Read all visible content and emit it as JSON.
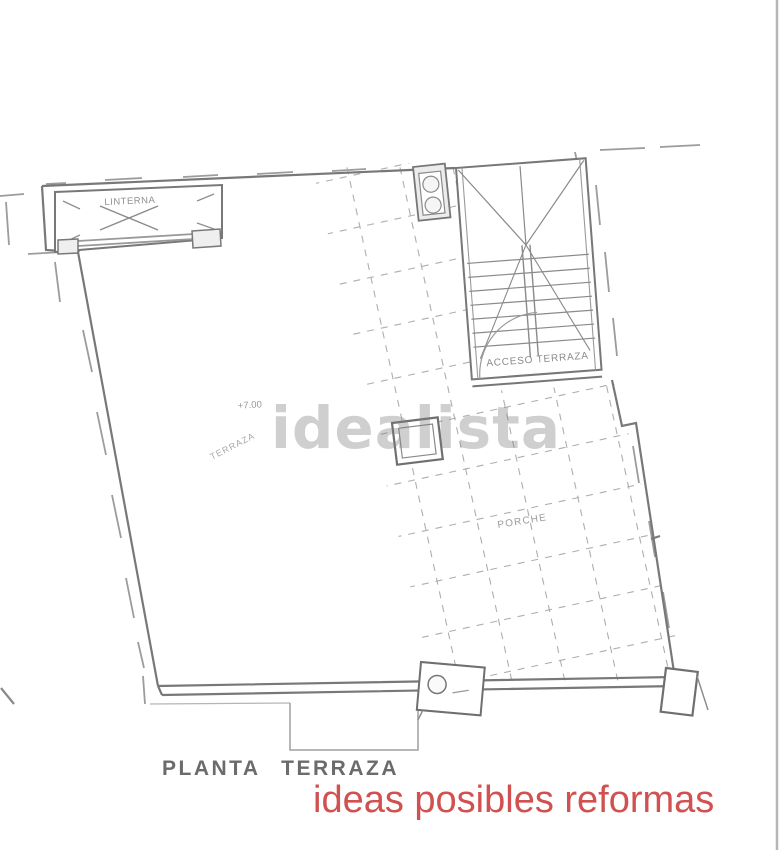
{
  "plan": {
    "skylight_label": "LINTERNA",
    "level_marker": "+7.00",
    "terrace_label": "TERRAZA",
    "stair_access_label": "ACCESO TERRAZA",
    "porch_label": "PORCHE",
    "drawing_title": "PLANTA TERRAZA"
  },
  "watermark": {
    "text": "idealista",
    "color": "#7d7d7d"
  },
  "footer": {
    "tagline": "ideas posibles reformas",
    "color": "#d15150"
  },
  "colors": {
    "wall": "#787878",
    "dashed_boundary": "#9c9c9c",
    "tile_grid": "#aeaeae"
  }
}
